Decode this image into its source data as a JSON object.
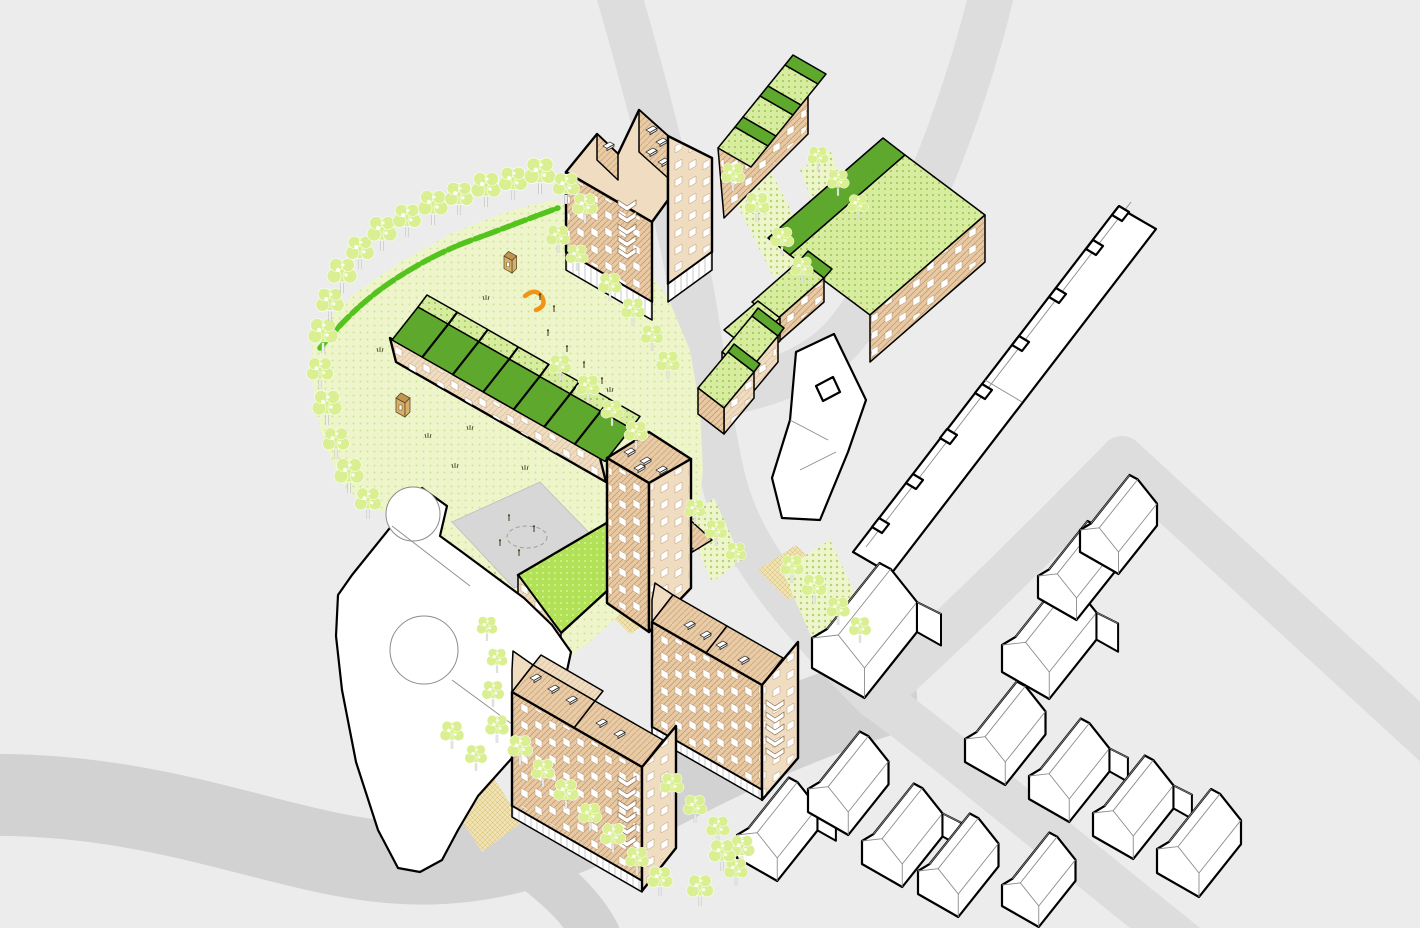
{
  "meta": {
    "title": "Axonometric urban block development diagram",
    "image_type": "architectural site-plan illustration, bird's-eye axonometric view",
    "visible_text": "none"
  },
  "palette": {
    "background": "#ececec",
    "road": "#dddddd",
    "road_major": "#d2d2d2",
    "lawn": "#eef5cb",
    "lawn_dot": "#cfe49b",
    "lawn_dot_dark": "#b2d574",
    "hedge_green": "#55c31e",
    "roof_dark_green": "#5fa82e",
    "roof_light_green": "#d7ec9f",
    "roof_light_dot": "#96ca52",
    "flat_roof_green": "#b1e156",
    "flat_roof_dot": "#d9f29b",
    "wall_tan_light": "#f0dcc0",
    "wall_tan_shaded": "#e7c9a4",
    "wall_hatch": "#c99c72",
    "roof_tan": "#e9cba6",
    "roof_hatch": "#d0a87c",
    "window_white": "#ffffff",
    "window_frame": "#b49b7c",
    "outline": "#000000",
    "context_fill": "#ffffff",
    "context_line": "#8c8c8c",
    "path_beige": "#efe3b4",
    "path_hatch": "#d8bd72",
    "playground_grey": "#d7d7d7",
    "playground_mark": "#9f9f9f",
    "tree_fill": "#d9ef92",
    "tree_trunk": "#ffffff",
    "tree_trunk_line": "#b3b3ab",
    "hut_tan": "#d8b06a",
    "hut_roof": "#c09452",
    "play_orange": "#f19315",
    "figure_dark": "#4a4a28"
  },
  "scene": {
    "view": "axonometric view of a proposed residential block beside existing streets",
    "areas": {
      "park": "large lawn with perimeter tree row and hedgerow on the north-west edge",
      "playground": "grey paved diamond with play markings and tiny figures",
      "street_planting_patches": 5,
      "footpaths_beige": 3,
      "lawn_strip_west_of_south_block": 1
    },
    "proposed_buildings": [
      {
        "id": "tall-twin-gable-apartments",
        "roof": "tan pitched with rooflights",
        "features": [
          "chevron balconies",
          "ground-floor colonnade",
          "hatched tan facades"
        ]
      },
      {
        "id": "north-green-roof-terrace",
        "roof": "green pitched, three stepped bays"
      },
      {
        "id": "northeast-l-block",
        "roof": "green pitched, long wing plus stepped south-west wing"
      },
      {
        "id": "green-roof-cottage-pair",
        "roof": "green pitched, two small bays"
      },
      {
        "id": "park-terrace-green-sawtooth",
        "roof": "green sawtooth, seven stepped bays"
      },
      {
        "id": "corner-tower",
        "roof": "flat tan with rooflights"
      },
      {
        "id": "green-flat-roof-wing",
        "roof": "bright green flat roof"
      },
      {
        "id": "rooflight-wing",
        "roof": "small tan wing with rooflights"
      },
      {
        "id": "southwest-apartment-block",
        "roof": "tan pitched with rooflights",
        "features": [
          "chevron balconies",
          "colonnade",
          "street tree row in front"
        ]
      },
      {
        "id": "southeast-apartment-block",
        "roof": "tan pitched with rooflights",
        "features": [
          "chevron balconies",
          "colonnade"
        ]
      }
    ],
    "context_buildings": [
      {
        "id": "retained-hall-with-rounded-bays",
        "style": "white with two cylindrical bays"
      },
      {
        "id": "long-rowhouse-terrace-with-chimneys",
        "style": "white, pitched roof, chimney stacks"
      },
      {
        "id": "flat-roof-l-building",
        "style": "white flat-roof block"
      },
      {
        "id": "junction-gabled-house",
        "style": "white detached gabled house"
      },
      {
        "id": "l-shaped-house",
        "style": "white house with rear wing"
      },
      {
        "id": "detached-houses-northeast",
        "count": 2
      },
      {
        "id": "rowhouse-row-southwest",
        "count": 5
      },
      {
        "id": "rowhouse-row-northeast",
        "count": 4
      }
    ],
    "roads": {
      "junction": "X-shaped crossing south-east of the block",
      "segments": [
        "north approach",
        "northeast curve",
        "southwest sweep",
        "south fork",
        "northeast arm",
        "east corner arm",
        "southeast arm"
      ]
    },
    "landscape": {
      "tree_count": 62,
      "hedgerow": "bright green hedge along park north-west edge",
      "play_huts": 2,
      "play_equipment": "orange slide",
      "details": "grass tufts and tiny human figures in park and playground"
    }
  }
}
